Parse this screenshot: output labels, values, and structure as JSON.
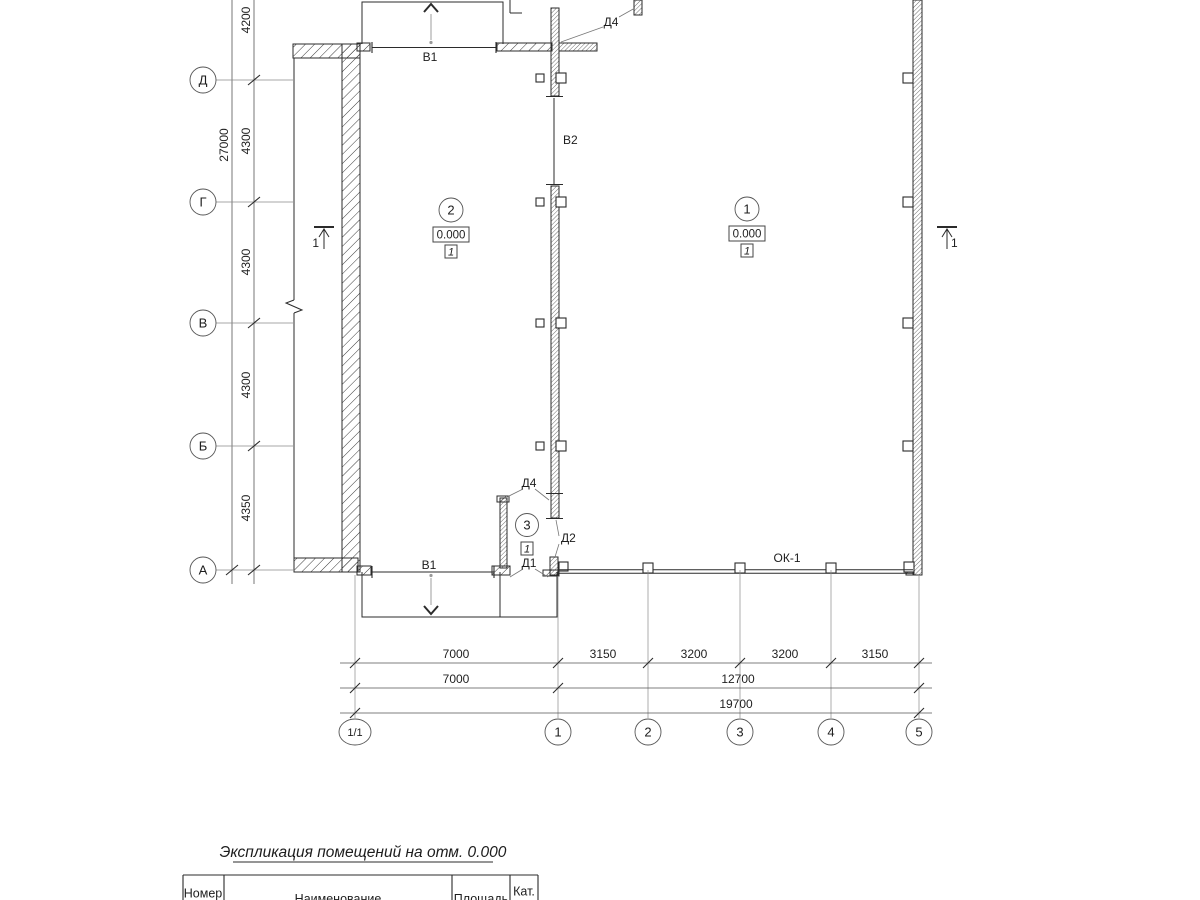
{
  "plan": {
    "left_axis": {
      "labels": [
        "Д",
        "Г",
        "В",
        "Б",
        "А"
      ],
      "dims": [
        "4200",
        "4300",
        "4300",
        "4300",
        "4350"
      ],
      "overall_dim": "27000"
    },
    "bottom_axis": {
      "labels": [
        "1/1",
        "1",
        "2",
        "3",
        "4",
        "5"
      ],
      "dims_top": [
        "7000",
        "3150",
        "3200",
        "3200",
        "3150"
      ],
      "dims_mid": [
        "7000",
        "12700"
      ],
      "dims_total": "19700"
    },
    "rooms": {
      "room1": {
        "number": "1",
        "elevation": "0.000",
        "category": "1"
      },
      "room2": {
        "number": "2",
        "elevation": "0.000",
        "category": "1"
      },
      "room3": {
        "number": "3",
        "category": "1"
      }
    },
    "labels": {
      "gate_top": "В1",
      "gate_bottom": "В1",
      "gate_middle": "В2",
      "door_d4_top": "Д4",
      "door_d4_room3": "Д4",
      "door_d2": "Д2",
      "door_d1": "Д1",
      "window": "ОК-1"
    },
    "section_marks": {
      "left": "1",
      "right": "1"
    }
  },
  "schedule": {
    "title": "Экспликация помещений на отм. 0.000",
    "headers": [
      "Номер",
      "Наименование",
      "Площадь",
      "Кат."
    ]
  },
  "colors": {
    "line": "#2b2b2b",
    "dim_line": "#555555",
    "leader": "#777777",
    "arrow_shaft": "#b3b3b3",
    "background": "#ffffff"
  }
}
